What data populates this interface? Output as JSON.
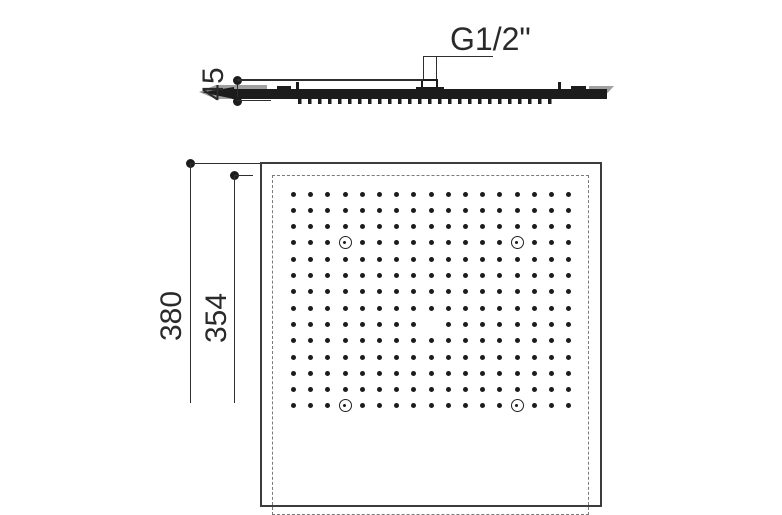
{
  "drawing": {
    "type": "technical-drawing",
    "subject": "square ceiling rain shower head"
  },
  "side_view": {
    "thread_label": "G1/2\"",
    "height_dim": "45"
  },
  "plan_view": {
    "outer_dim": "380",
    "inner_dim": "354",
    "nozzle_grid": {
      "columns": 17,
      "rows_visible": 14,
      "missing_positions": [
        {
          "row": 9,
          "col": 9
        }
      ],
      "mounting_holes": [
        {
          "row": 4,
          "col": 4
        },
        {
          "row": 4,
          "col": 14
        },
        {
          "row": 14,
          "col": 4
        },
        {
          "row": 14,
          "col": 14
        }
      ]
    }
  },
  "colors": {
    "ink": "#1c1c1c",
    "line": "#2e2e2e",
    "text": "#2a2a2a",
    "dash": "#7a7a7a",
    "gray": "#a0a0a0",
    "background": "#ffffff"
  }
}
